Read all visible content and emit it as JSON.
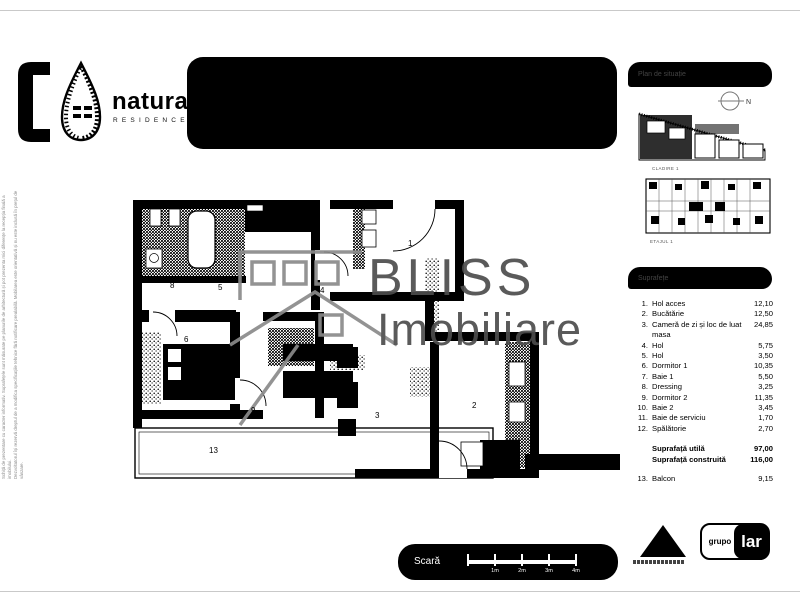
{
  "brand": {
    "name": "natura",
    "tagline": "RESIDENCE"
  },
  "site_panel": {
    "title": "Plan de situație",
    "building_caption": "CLADIRE 1",
    "floor_caption": "ETAJUL 1",
    "compass_label": "N"
  },
  "legend": {
    "title": "Suprafețe",
    "items": [
      {
        "no": "1.",
        "label": "Hol acces",
        "value": "12,10"
      },
      {
        "no": "2.",
        "label": "Bucătărie",
        "value": "12,50"
      },
      {
        "no": "3.",
        "label": "Cameră de zi și loc de luat masa",
        "value": "24,85"
      },
      {
        "no": "4.",
        "label": "Hol",
        "value": "5,75"
      },
      {
        "no": "5.",
        "label": "Hol",
        "value": "3,50"
      },
      {
        "no": "6.",
        "label": "Dormitor 1",
        "value": "10,35"
      },
      {
        "no": "7.",
        "label": "Baie 1",
        "value": "5,50"
      },
      {
        "no": "8.",
        "label": "Dressing",
        "value": "3,25"
      },
      {
        "no": "9.",
        "label": "Dormitor 2",
        "value": "11,35"
      },
      {
        "no": "10.",
        "label": "Baie 2",
        "value": "3,45"
      },
      {
        "no": "11.",
        "label": "Baie de serviciu",
        "value": "1,70"
      },
      {
        "no": "12.",
        "label": "Spălătorie",
        "value": "2,70"
      }
    ],
    "totals": [
      {
        "label": "Suprafață utilă",
        "value": "97,00"
      },
      {
        "label": "Suprafață construită",
        "value": "116,00"
      }
    ],
    "balcony": {
      "no": "13.",
      "label": "Balcon",
      "value": "9,15"
    }
  },
  "plan": {
    "watermark": {
      "line1": "BLISS",
      "line2": "Imobiliare"
    },
    "rooms": [
      {
        "n": "1"
      },
      {
        "n": "2"
      },
      {
        "n": "3"
      },
      {
        "n": "4"
      },
      {
        "n": "5"
      },
      {
        "n": "6"
      },
      {
        "n": "8"
      },
      {
        "n": "9"
      },
      {
        "n": "13"
      }
    ]
  },
  "scalebar": {
    "label": "Scară",
    "ticks": [
      "1m",
      "2m",
      "3m",
      "4m"
    ]
  },
  "logos": {
    "grupo": "grupo",
    "lar": "lar"
  },
  "disclaimer": {
    "line1": "Schiță de prezentare cu caracter informativ. Suprafețele sunt măsurate pe planurile de arhitectură și pot prezenta mici diferențe la recepția finală a imobilului.",
    "line2": "Dezvoltatorul își rezervă dreptul de a modifica specificațiile tehnice fără notificare prealabilă. Mobilarea este orientativă și nu este inclusă în prețul de vânzare."
  }
}
